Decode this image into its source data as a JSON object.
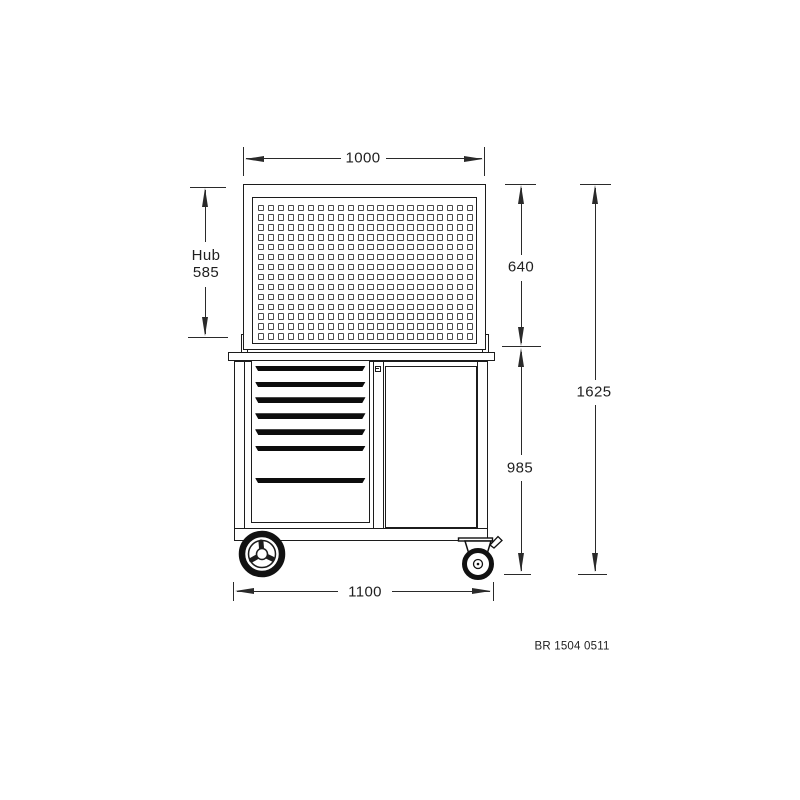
{
  "drawing": {
    "title": "workshop-trolley-front-view",
    "dimensions": {
      "top_width": "1000",
      "hub_label": "Hub",
      "hub_value": "585",
      "panel_height": "640",
      "lower_height": "985",
      "total_height": "1625",
      "bottom_width": "1100"
    },
    "part_number": "BR 1504 0511",
    "pegboard": {
      "rows": 14,
      "cols": 22,
      "start_x": 258,
      "start_y": 204.5,
      "pitch_x": 9.95,
      "pitch_y": 9.9
    },
    "drawers": {
      "count": 7,
      "tops": [
        365.7,
        381.7,
        397.3,
        413.3,
        429.3,
        445.7,
        477.7
      ]
    },
    "colors": {
      "object_line": "#1c1c1c",
      "dimension_line": "#2a2a2a",
      "handle_fill": "#0d0d0d",
      "background": "#ffffff"
    }
  }
}
